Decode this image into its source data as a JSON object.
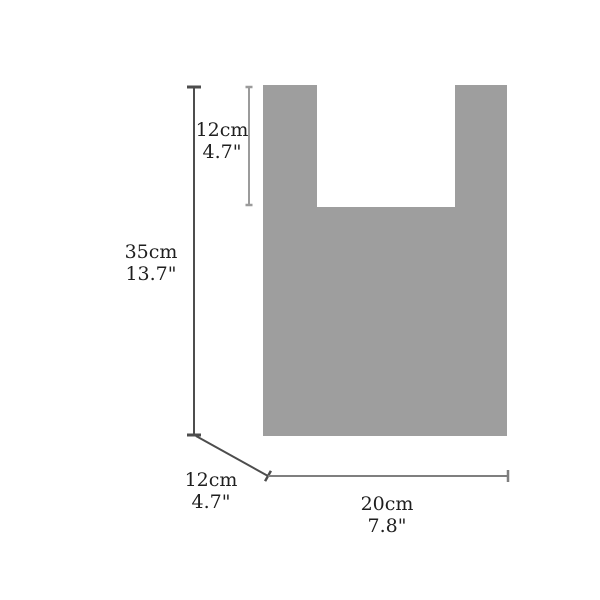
{
  "diagram": {
    "type": "bag-dimension-diagram",
    "bag_fill": "#9e9e9e",
    "line_colors": {
      "dark": "#4d4d4d",
      "light": "#9b9b9b",
      "mid": "#7f7f7f"
    },
    "text_color": "#1f1f1f",
    "labels": {
      "handle_height": {
        "cm": "12cm",
        "inch": "4.7\""
      },
      "total_height": {
        "cm": "35cm",
        "inch": "13.7\""
      },
      "depth": {
        "cm": "12cm",
        "inch": "4.7\""
      },
      "width": {
        "cm": "20cm",
        "inch": "7.8\""
      }
    }
  }
}
